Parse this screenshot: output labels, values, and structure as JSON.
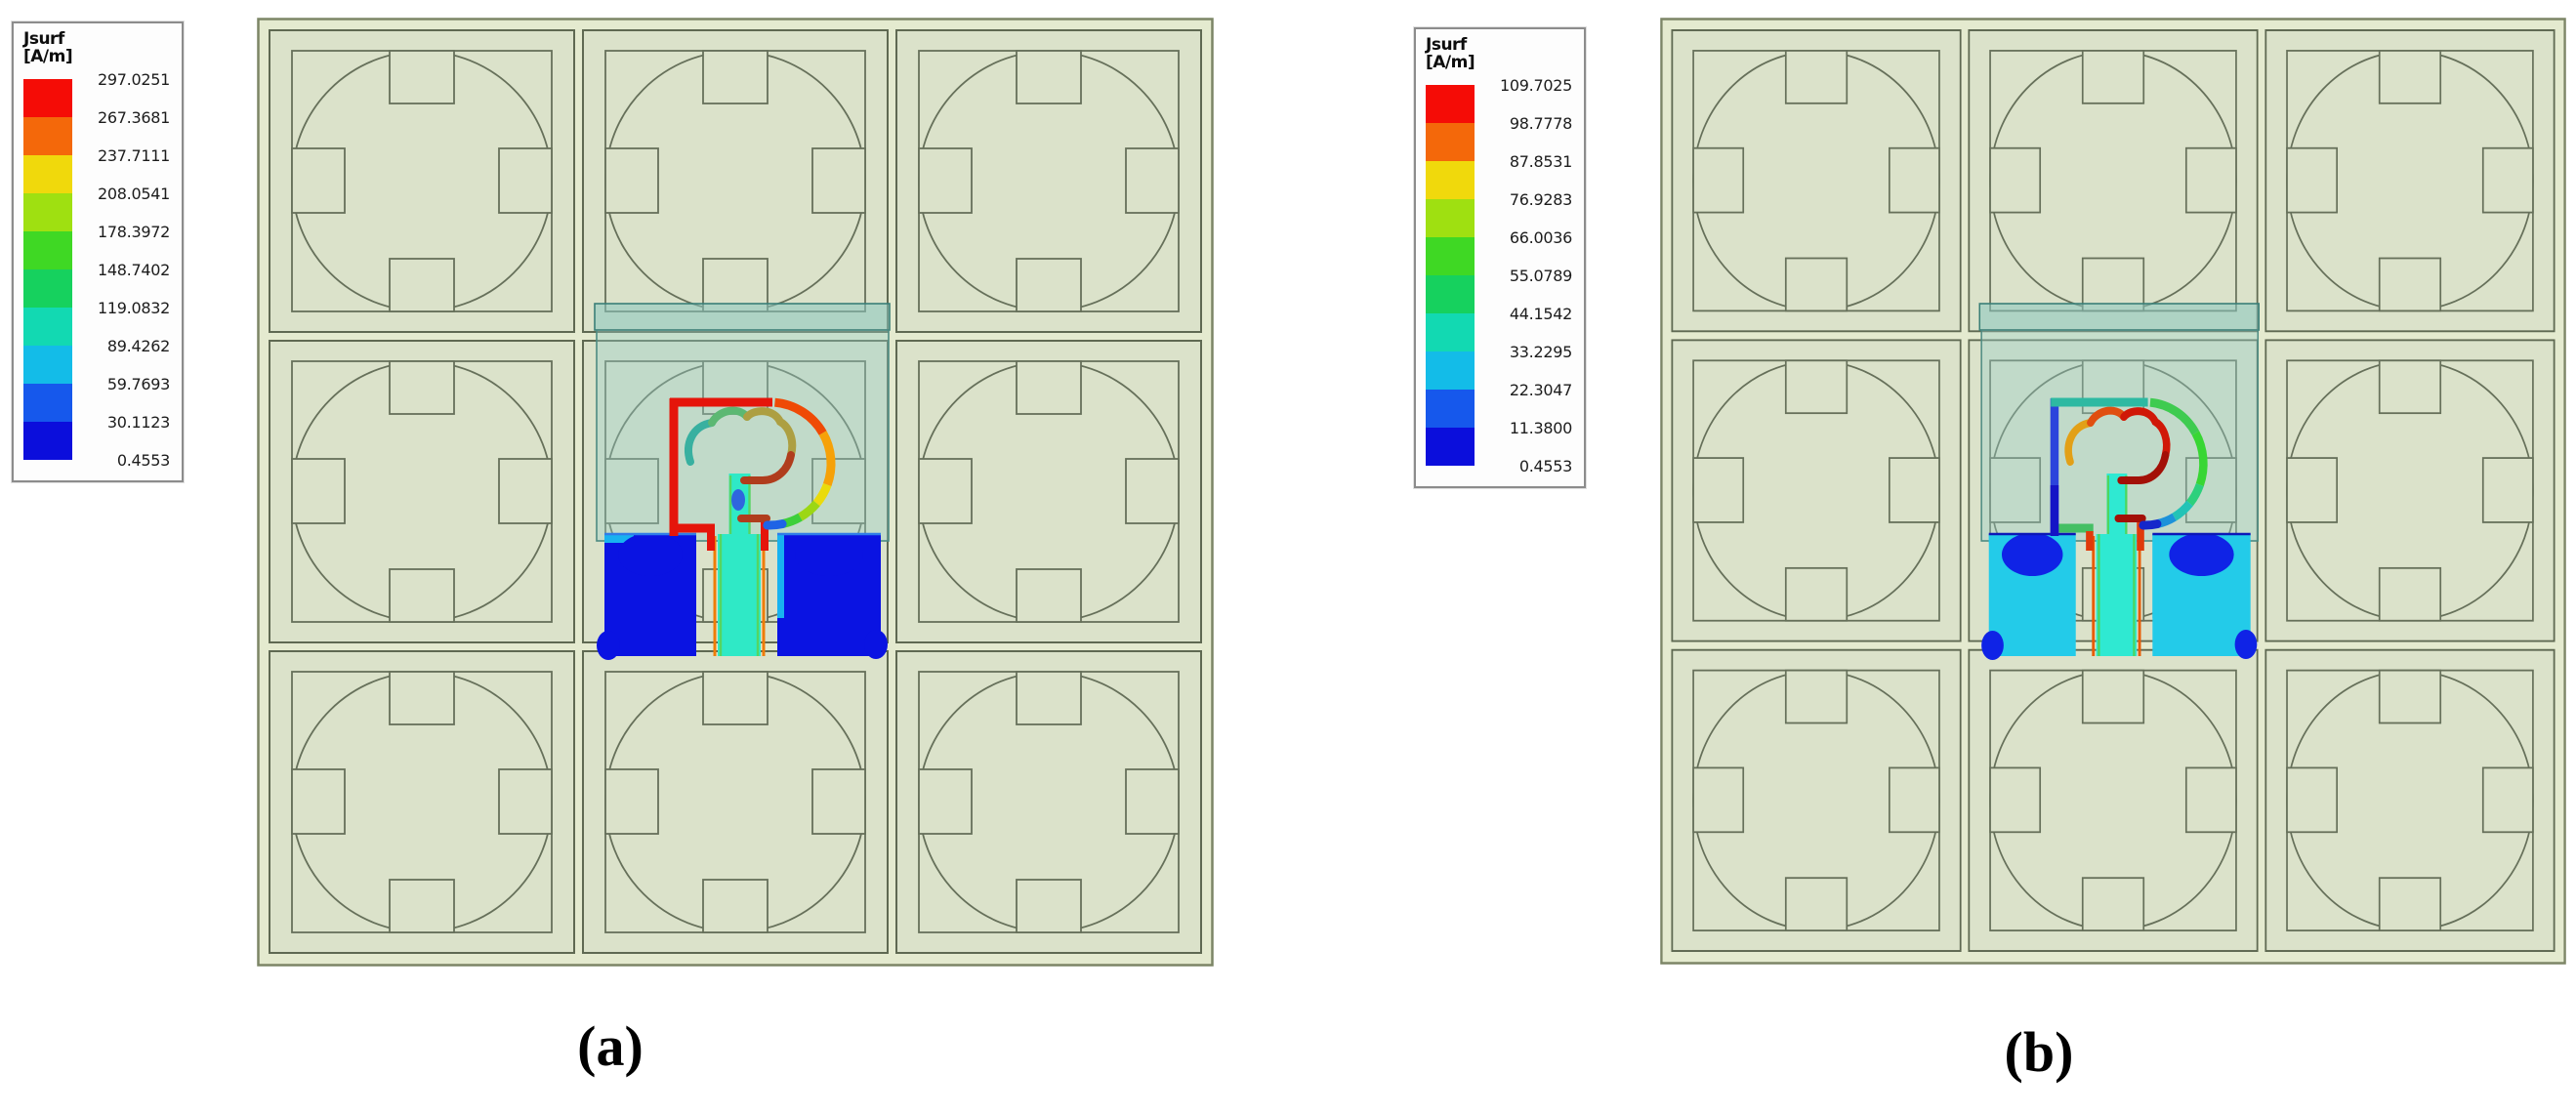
{
  "figure": {
    "type": "simulation_surface_current_plots",
    "captions": {
      "a": "(a)",
      "b": "(b)"
    }
  },
  "legend_title": [
    "Jsurf",
    "[A/m]"
  ],
  "colorbar_colors": [
    "#f50c06",
    "#f4680a",
    "#f0d90c",
    "#9fe011",
    "#3fd824",
    "#16d15e",
    "#12d9b2",
    "#13bce8",
    "#1658ec",
    "#0b0edc"
  ],
  "panels": {
    "a": {
      "legend_values": [
        "297.0251",
        "267.3681",
        "237.7111",
        "208.0541",
        "178.3972",
        "148.7402",
        "119.0832",
        "89.4262",
        "59.7693",
        "30.1123",
        "0.4553"
      ],
      "antenna_colors": {
        "outerBar": "#e5150b",
        "outerBarLow": "#e5150b",
        "outerTop": "#e5150b",
        "arc1": "#ef4a06",
        "arc2": "#f6a108",
        "arc3": "#eadb0c",
        "arc4": "#9cd714",
        "arc5": "#3ecf3a",
        "arcTip": "#1e63e6",
        "cloud1": "#38b0a0",
        "cloud2": "#5cb873",
        "cloud3": "#ad9f42",
        "cloud4": "#b03d1d",
        "junction": "#e5150b",
        "connector": "#e5150b",
        "feedCore": "#2fe9c6",
        "feedEdge": "#55d562",
        "feedThin": "#ef7d08",
        "feedSmudge": "#2f66de",
        "groundBase": "#0a13e2",
        "groundBlob": "#0a13e2",
        "groundEdge": "#2f7de8",
        "groundAccent": "#18b2f0"
      }
    },
    "b": {
      "legend_values": [
        "109.7025",
        "98.7778",
        "87.8531",
        "76.9283",
        "66.0036",
        "55.0789",
        "44.1542",
        "33.2295",
        "22.3047",
        "11.3800",
        "0.4553"
      ],
      "antenna_colors": {
        "outerBar": "#2b44dc",
        "outerBarLow": "#1414c6",
        "outerTop": "#2eb9a2",
        "arc1": "#3ecb50",
        "arc2": "#38d634",
        "arc3": "#2dd07c",
        "arc4": "#23c3b6",
        "arc5": "#1c92da",
        "arcTip": "#1526cb",
        "cloud1": "#e2a017",
        "cloud2": "#e04f10",
        "cloud3": "#d01808",
        "cloud4": "#a31007",
        "junction": "#e03a0a",
        "connector": "#44bf64",
        "feedCore": "#2fe9d2",
        "feedEdge": "#4cd65e",
        "feedThin": "#e85c06",
        "feedSmudge": "transparent",
        "groundBase": "#23cbe9",
        "groundBlob": "#0f23e6",
        "groundEdge": "#0c17b8",
        "groundAccent": "#23cbe9"
      }
    }
  },
  "palette": {
    "page_background": "#ffffff",
    "cell_fill": "#dbe2ca",
    "cell_line": "#5f6952",
    "frame_fill": "#e4eacf",
    "substrate_teal": "#8fc9c2",
    "legend_border": "#8c8c8c"
  }
}
